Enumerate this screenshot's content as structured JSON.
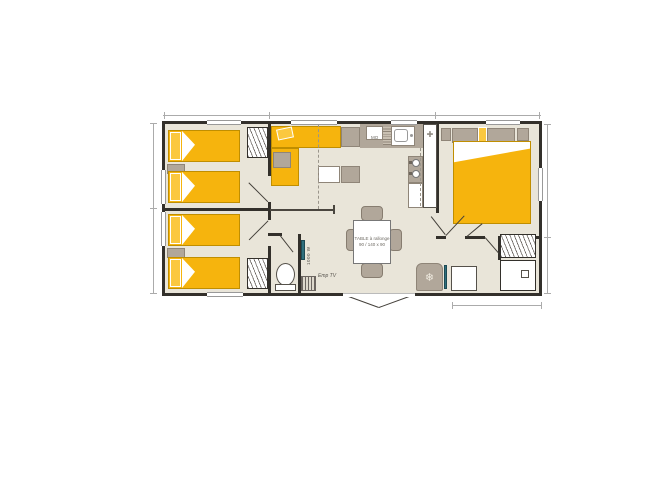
{
  "plan": {
    "labels": {
      "microwave": "MO",
      "table_line1": "TABLE à rallonge",
      "table_line2": "90 / 140 x 90",
      "water_heater": "1000 W",
      "tv_spot": "Emp TV"
    },
    "icons": {
      "snowflake": "❄",
      "kitchen_cross": "✚"
    },
    "colors": {
      "bed_yellow": "#F6B40D",
      "pillow_yellow": "#FBC83F",
      "floor_beige": "#E9E5D9",
      "furniture_gray": "#B1A79A",
      "wall_dark": "#33302B",
      "accent_teal": "#2E6F7D",
      "dimension_gray": "#ABABAB"
    }
  }
}
